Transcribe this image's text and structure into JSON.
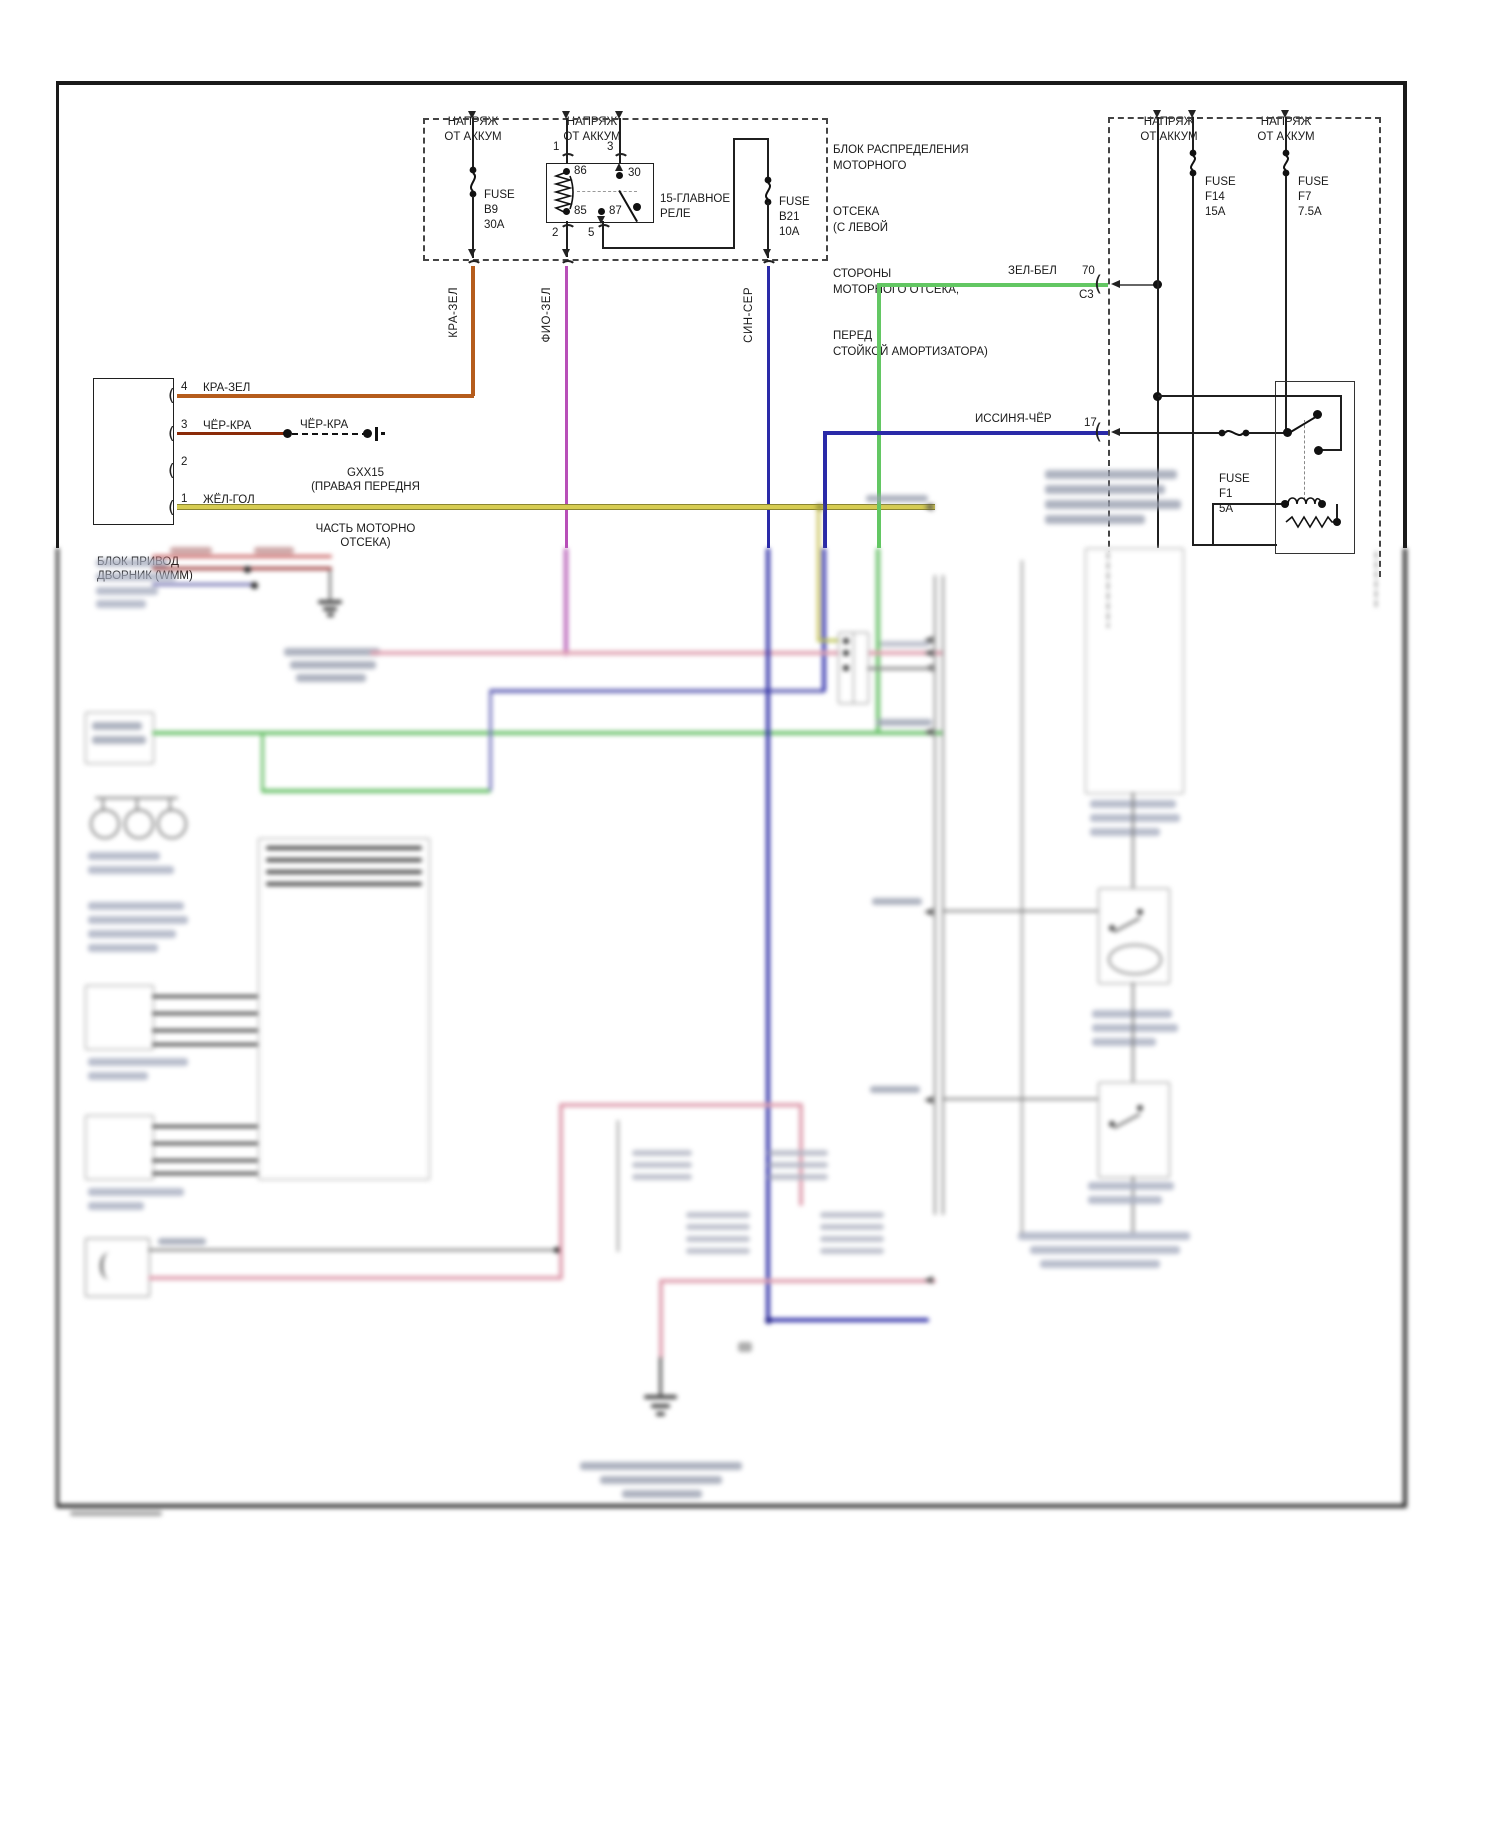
{
  "diagram": {
    "power_label": {
      "line1": "НАПРЯЖ",
      "line2": "ОТ АККУМ"
    },
    "fuses": {
      "b9": {
        "name": "FUSE",
        "id": "B9",
        "rating": "30A"
      },
      "b21": {
        "name": "FUSE",
        "id": "B21",
        "rating": "10A"
      },
      "f14": {
        "name": "FUSE",
        "id": "F14",
        "rating": "15A"
      },
      "f7": {
        "name": "FUSE",
        "id": "F7",
        "rating": "7.5A"
      },
      "f1": {
        "name": "FUSE",
        "id": "F1",
        "rating": "5A"
      }
    },
    "relay": {
      "label_line1": "15-ГЛАВНОЕ",
      "label_line2": "РЕЛЕ",
      "pin1": "1",
      "pin3": "3",
      "pin2": "2",
      "pin5": "5",
      "pin86": "86",
      "pin85": "85",
      "pin30": "30",
      "pin87": "87"
    },
    "dist_block_label": {
      "l1": "БЛОК РАСПРЕДЕЛЕНИЯ",
      "l2": "МОТОРНОГО",
      "l3": "ОТСЕКА",
      "l4": "(С ЛЕВОЙ",
      "l5": "СТОРОНЫ",
      "l6": "МОТОРНОГО ОТСЕКА,",
      "l7": "ПЕРЕД",
      "l8": "СТОЙКОЙ АМОРТИЗАТОРА)"
    },
    "left_block": {
      "title_line1": "БЛОК ПРИВОД",
      "title_line2": "ДВОРНИК (WMM)",
      "pin4": "4",
      "pin3": "3",
      "pin2": "2",
      "pin1": "1",
      "wire4": "КРА-ЗЕЛ",
      "wire3": "ЧЁР-КРА",
      "wire1": "ЖЁЛ-ГОЛ"
    },
    "splice": {
      "wire": "ЧЁР-КРА",
      "code": "GXX15",
      "loc1": "(ПРАВАЯ ПЕРЕДНЯ",
      "loc2": "ЧАСТЬ МОТОРНО",
      "loc3": "ОТСЕКА)"
    },
    "vertical_wires": {
      "kra_zel": "КРА-ЗЕЛ",
      "fio_zel": "ФИО-ЗЕЛ",
      "sin_ser": "СИН-СЕР"
    },
    "connector_zel_bel": {
      "wire": "ЗЕЛ-БЕЛ",
      "pin": "70",
      "connector": "C3"
    },
    "connector_issinya": {
      "wire": "ИССИНЯ-ЧЁР",
      "pin": "17"
    },
    "colors": {
      "wire_orange": "#b55c1c",
      "wire_dark_red": "#8a2a08",
      "wire_yellow": "#d6cc52",
      "wire_magenta": "#b84fb8",
      "wire_blue": "#2a2aa8",
      "wire_green": "#63c763",
      "wire_pink": "#e0a0b0",
      "wire_gray": "#777777",
      "line_black": "#1f1f1f"
    }
  }
}
